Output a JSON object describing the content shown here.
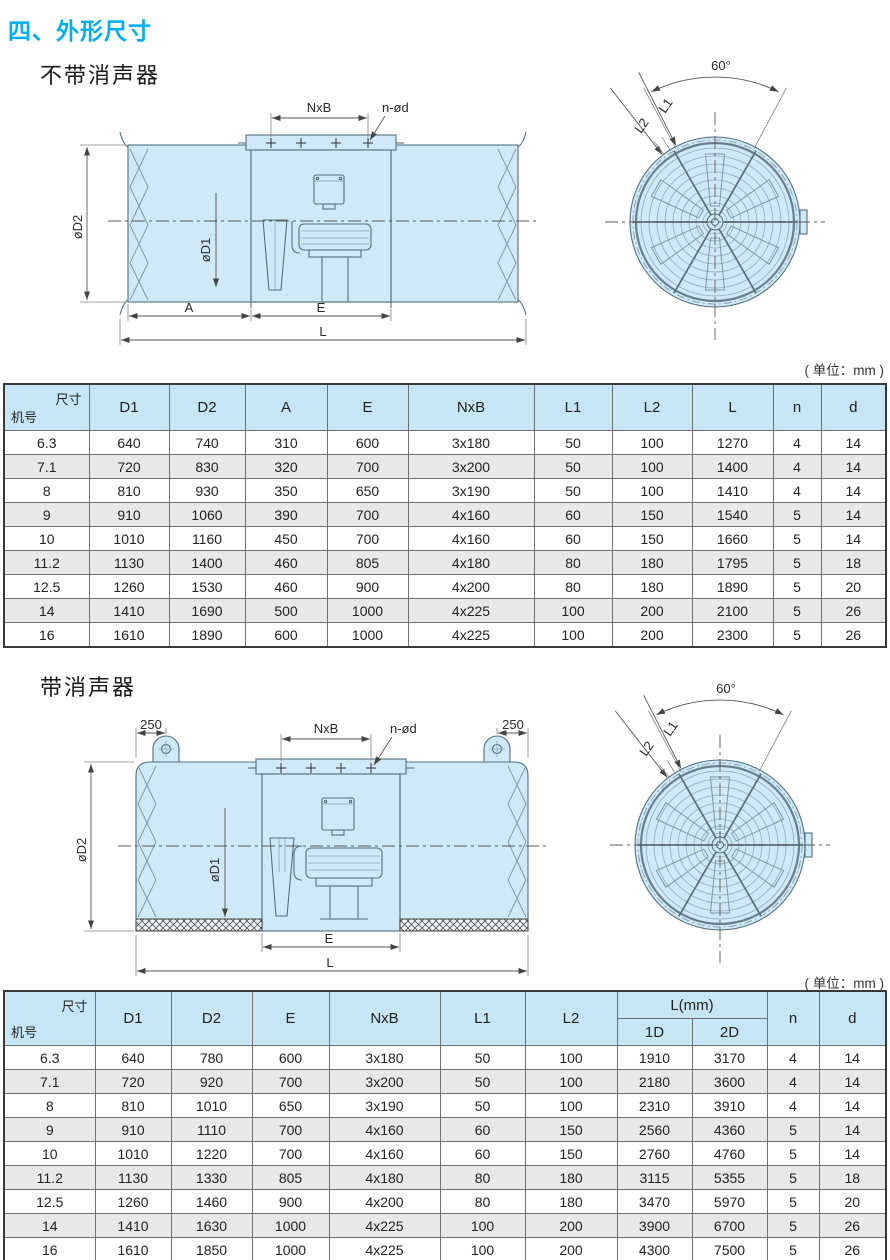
{
  "page": {
    "title": "四、外形尺寸",
    "accent_color": "#00aeef",
    "header_bg": "#c7e6f5",
    "row_alt_bg": "#e8e8e8",
    "drawing_fill": "#cfe9f7"
  },
  "drawing": {
    "nxb": "NxB",
    "n_od": "n-ød",
    "od2": "øD2",
    "od1": "øD1",
    "dim_a": "A",
    "dim_e": "E",
    "dim_l": "L",
    "angle": "60°",
    "l1": "L1",
    "l2": "L2",
    "lug": "250"
  },
  "section1": {
    "heading": "不带消声器",
    "unit_note": "( 单位：mm )",
    "table": {
      "corner_top": "尺寸",
      "corner_bottom": "机号",
      "columns": [
        "D1",
        "D2",
        "A",
        "E",
        "NxB",
        "L1",
        "L2",
        "L",
        "n",
        "d"
      ],
      "rows": [
        [
          "6.3",
          "640",
          "740",
          "310",
          "600",
          "3x180",
          "50",
          "100",
          "1270",
          "4",
          "14"
        ],
        [
          "7.1",
          "720",
          "830",
          "320",
          "700",
          "3x200",
          "50",
          "100",
          "1400",
          "4",
          "14"
        ],
        [
          "8",
          "810",
          "930",
          "350",
          "650",
          "3x190",
          "50",
          "100",
          "1410",
          "4",
          "14"
        ],
        [
          "9",
          "910",
          "1060",
          "390",
          "700",
          "4x160",
          "60",
          "150",
          "1540",
          "5",
          "14"
        ],
        [
          "10",
          "1010",
          "1160",
          "450",
          "700",
          "4x160",
          "60",
          "150",
          "1660",
          "5",
          "14"
        ],
        [
          "11.2",
          "1130",
          "1400",
          "460",
          "805",
          "4x180",
          "80",
          "180",
          "1795",
          "5",
          "18"
        ],
        [
          "12.5",
          "1260",
          "1530",
          "460",
          "900",
          "4x200",
          "80",
          "180",
          "1890",
          "5",
          "20"
        ],
        [
          "14",
          "1410",
          "1690",
          "500",
          "1000",
          "4x225",
          "100",
          "200",
          "2100",
          "5",
          "26"
        ],
        [
          "16",
          "1610",
          "1890",
          "600",
          "1000",
          "4x225",
          "100",
          "200",
          "2300",
          "5",
          "26"
        ]
      ]
    }
  },
  "section2": {
    "heading": "带消声器",
    "unit_note": "( 单位：mm )",
    "table": {
      "corner_top": "尺寸",
      "corner_bottom": "机号",
      "columns": [
        "D1",
        "D2",
        "E",
        "NxB",
        "L1",
        "L2"
      ],
      "l_group": "L(mm)",
      "l_sub": [
        "1D",
        "2D"
      ],
      "columns_tail": [
        "n",
        "d"
      ],
      "rows": [
        [
          "6.3",
          "640",
          "780",
          "600",
          "3x180",
          "50",
          "100",
          "1910",
          "3170",
          "4",
          "14"
        ],
        [
          "7.1",
          "720",
          "920",
          "700",
          "3x200",
          "50",
          "100",
          "2180",
          "3600",
          "4",
          "14"
        ],
        [
          "8",
          "810",
          "1010",
          "650",
          "3x190",
          "50",
          "100",
          "2310",
          "3910",
          "4",
          "14"
        ],
        [
          "9",
          "910",
          "1110",
          "700",
          "4x160",
          "60",
          "150",
          "2560",
          "4360",
          "5",
          "14"
        ],
        [
          "10",
          "1010",
          "1220",
          "700",
          "4x160",
          "60",
          "150",
          "2760",
          "4760",
          "5",
          "14"
        ],
        [
          "11.2",
          "1130",
          "1330",
          "805",
          "4x180",
          "80",
          "180",
          "3115",
          "5355",
          "5",
          "18"
        ],
        [
          "12.5",
          "1260",
          "1460",
          "900",
          "4x200",
          "80",
          "180",
          "3470",
          "5970",
          "5",
          "20"
        ],
        [
          "14",
          "1410",
          "1630",
          "1000",
          "4x225",
          "100",
          "200",
          "3900",
          "6700",
          "5",
          "26"
        ],
        [
          "16",
          "1610",
          "1850",
          "1000",
          "4x225",
          "100",
          "200",
          "4300",
          "7500",
          "5",
          "26"
        ]
      ]
    }
  }
}
